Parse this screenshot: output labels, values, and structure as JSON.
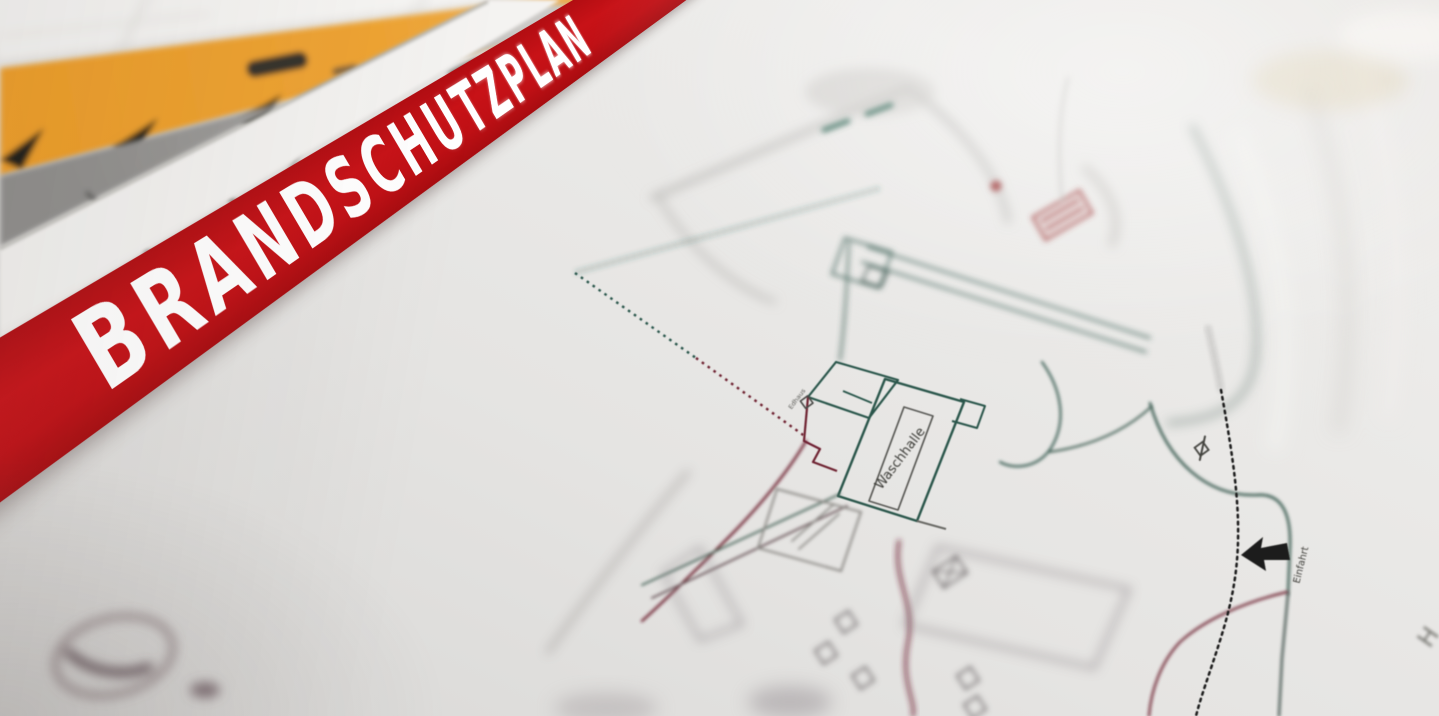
{
  "banner": {
    "title": "BRANDSCHUTZPLAN",
    "band_color": "#c21015",
    "text_color": "#ffffff"
  },
  "plan": {
    "labels": {
      "hall": "Waschhalle",
      "entrance": "Einfahrt",
      "gatehouse": "Edhaus",
      "corner_partial": "H"
    },
    "colors": {
      "outline_teal": "#2a564c",
      "outline_maroon": "#6e2430",
      "dotted_black": "#1c1c1c",
      "paper": "#e6e5e3"
    },
    "symbols": {
      "entrance_arrow": "left-arrow",
      "site_boundary": "dotted-line",
      "stamp": "round-stamp"
    }
  },
  "background_objects": {
    "ruler_color": "#efa02c",
    "clipboard_color": "#8f8e8c",
    "tile_surface_color": "#f6f5f3"
  }
}
